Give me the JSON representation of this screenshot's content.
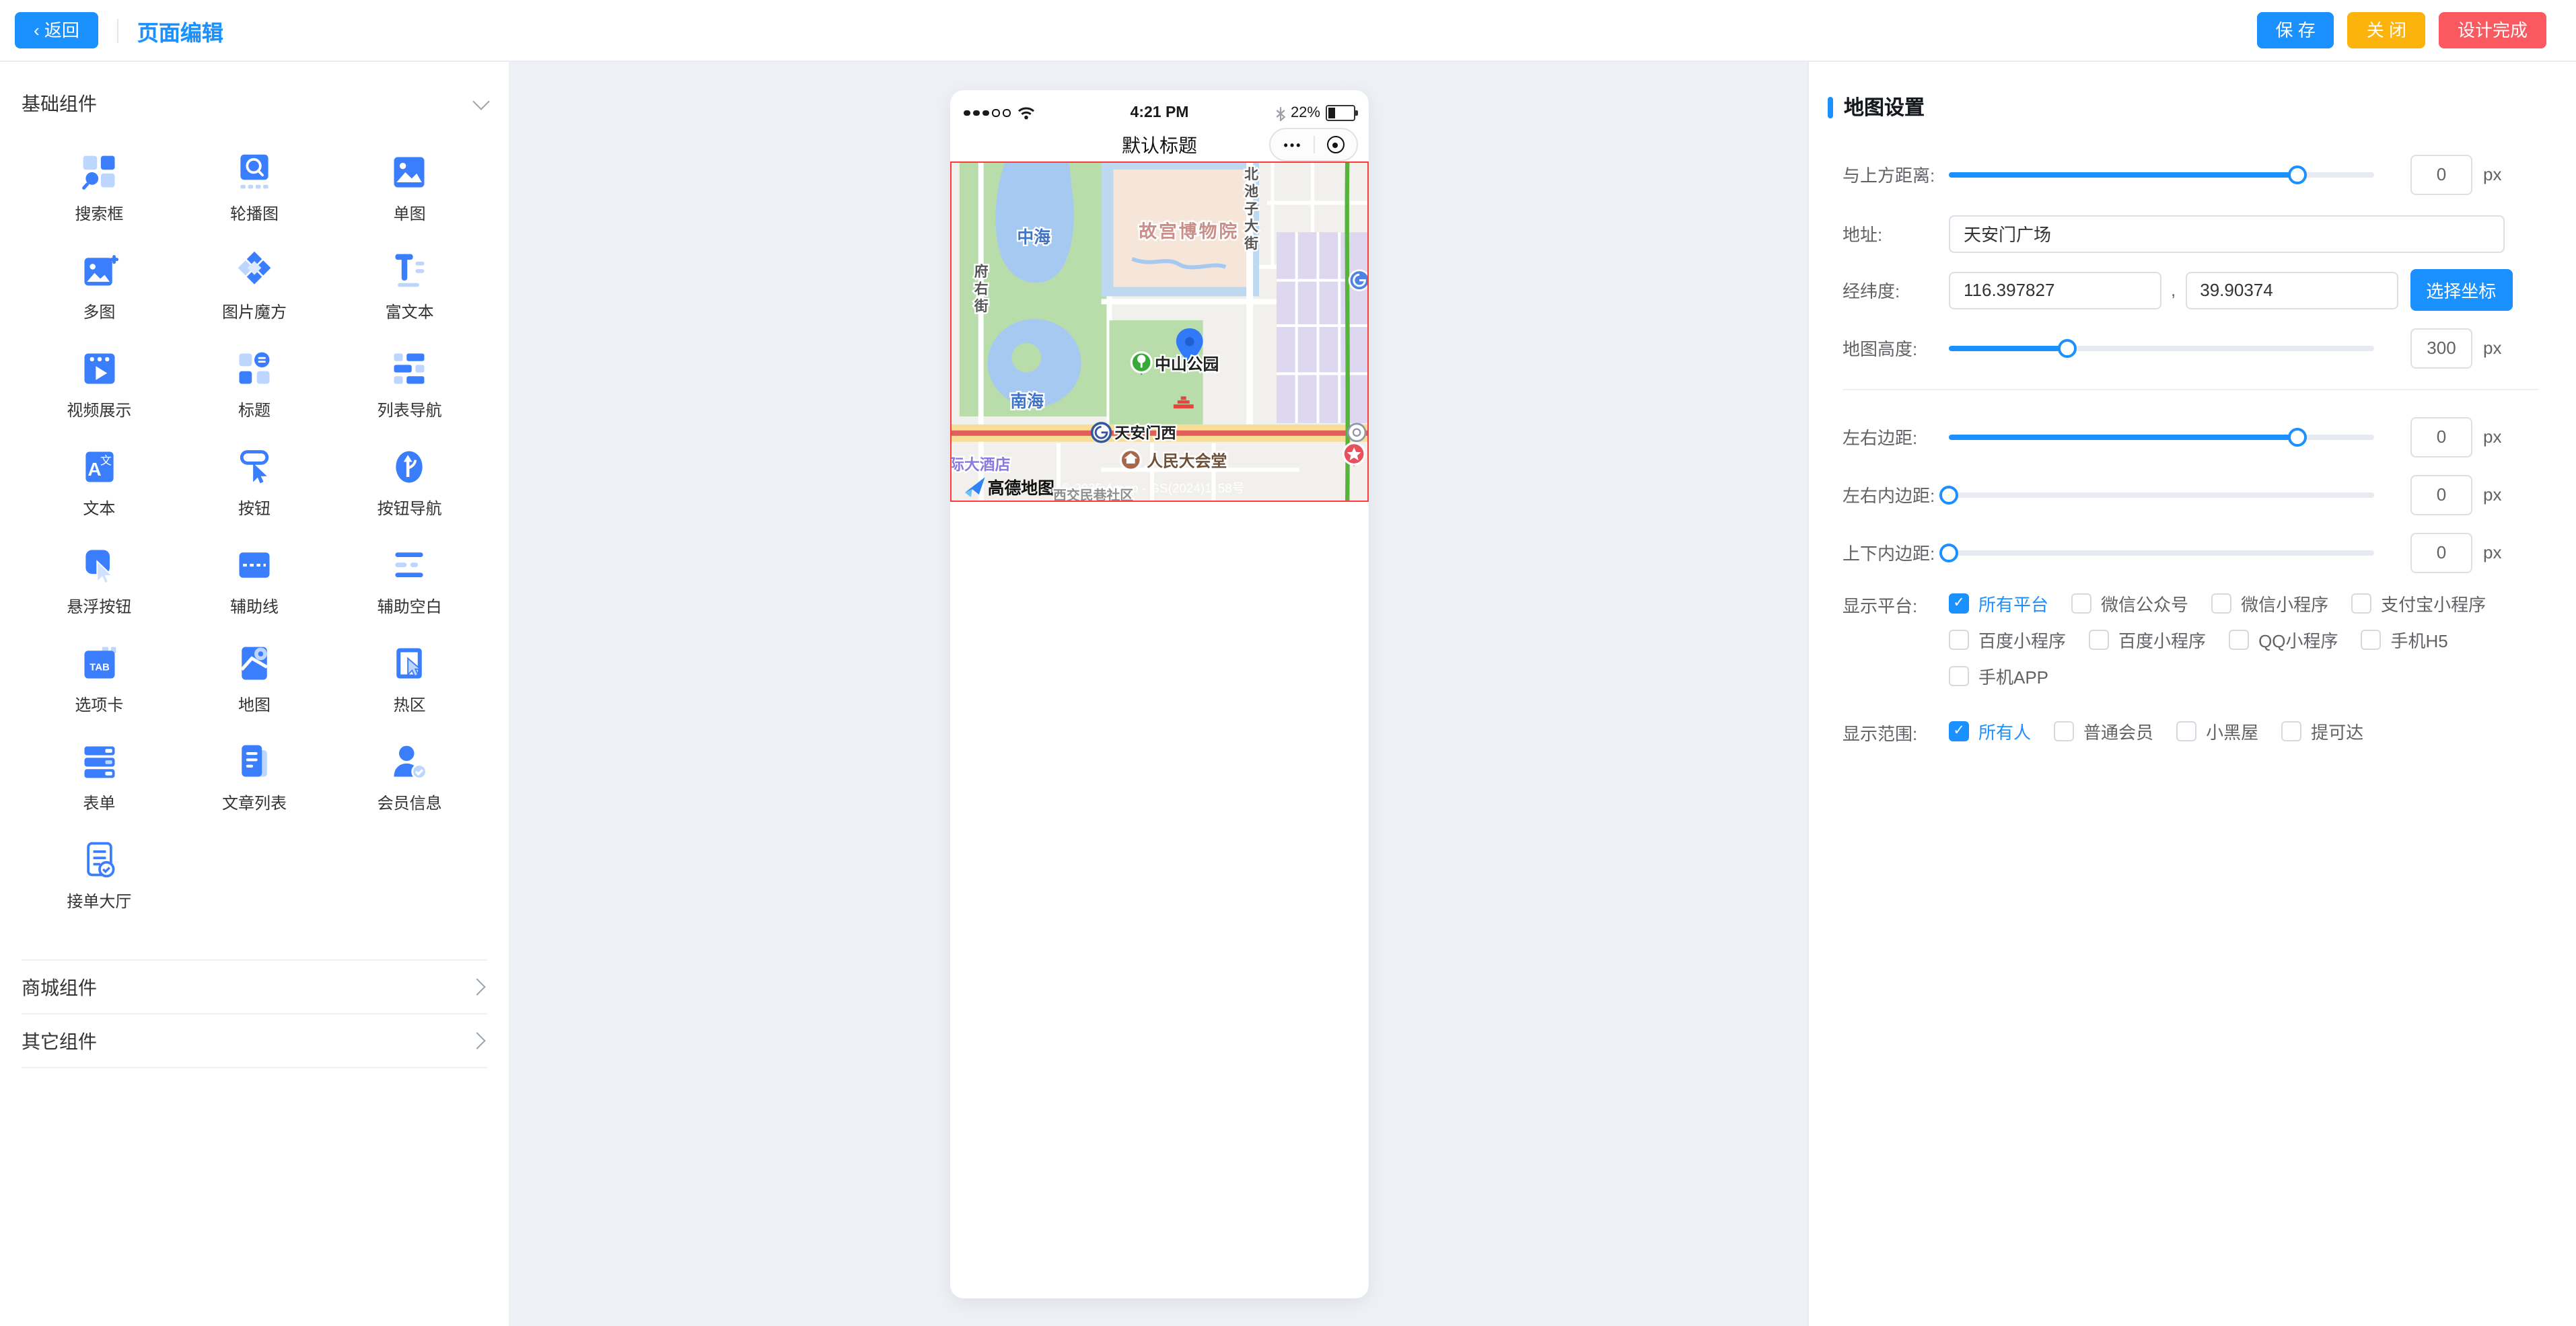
{
  "topbar": {
    "back_label": "‹ 返回",
    "page_title": "页面编辑",
    "save_label": "保 存",
    "close_label": "关 闭",
    "finish_label": "设计完成"
  },
  "sidebar": {
    "basic_section": "基础组件",
    "mall_section": "商城组件",
    "other_section": "其它组件",
    "components": [
      {
        "label": "搜索框",
        "icon": "search-box-icon"
      },
      {
        "label": "轮播图",
        "icon": "carousel-icon"
      },
      {
        "label": "单图",
        "icon": "single-image-icon"
      },
      {
        "label": "多图",
        "icon": "multi-image-icon"
      },
      {
        "label": "图片魔方",
        "icon": "image-cube-icon"
      },
      {
        "label": "富文本",
        "icon": "rich-text-icon"
      },
      {
        "label": "视频展示",
        "icon": "video-icon"
      },
      {
        "label": "标题",
        "icon": "title-icon"
      },
      {
        "label": "列表导航",
        "icon": "list-nav-icon"
      },
      {
        "label": "文本",
        "icon": "text-icon"
      },
      {
        "label": "按钮",
        "icon": "button-icon"
      },
      {
        "label": "按钮导航",
        "icon": "button-nav-icon"
      },
      {
        "label": "悬浮按钮",
        "icon": "float-button-icon"
      },
      {
        "label": "辅助线",
        "icon": "aux-line-icon"
      },
      {
        "label": "辅助空白",
        "icon": "aux-blank-icon"
      },
      {
        "label": "选项卡",
        "icon": "tab-icon"
      },
      {
        "label": "地图",
        "icon": "map-icon"
      },
      {
        "label": "热区",
        "icon": "hot-zone-icon"
      },
      {
        "label": "表单",
        "icon": "form-icon"
      },
      {
        "label": "文章列表",
        "icon": "article-list-icon"
      },
      {
        "label": "会员信息",
        "icon": "member-info-icon"
      },
      {
        "label": "接单大厅",
        "icon": "order-hall-icon"
      }
    ]
  },
  "phone": {
    "time": "4:21 PM",
    "battery_pct": "22%",
    "nav_title": "默认标题",
    "capsule_more": "•••"
  },
  "map": {
    "labels": {
      "gugong": "故宫博物院",
      "zhonghai": "中海",
      "nanhai": "南海",
      "zhongshan_park": "中山公园",
      "tiananmen_west": "天安门西",
      "great_hall": "人民大会堂",
      "hotel": "际大酒店",
      "amap_logo": "高德地图",
      "copyright": "© 2025 Amap - GS(2024)1158号",
      "community": "西交民巷社区",
      "fuyou": [
        "府",
        "右",
        "街"
      ],
      "beichizi": [
        "北",
        "池",
        "子",
        "大",
        "街"
      ]
    }
  },
  "panel": {
    "title": "地图设置",
    "top_margin": {
      "label": "与上方距离:",
      "value": "0",
      "unit": "px",
      "fill_pct": 82
    },
    "address": {
      "label": "地址:",
      "value": "天安门广场"
    },
    "coords": {
      "label": "经纬度:",
      "lng": "116.397827",
      "lat": "39.90374",
      "separator": ",",
      "pick_btn": "选择坐标"
    },
    "map_height": {
      "label": "地图高度:",
      "value": "300",
      "unit": "px",
      "fill_pct": 28
    },
    "lr_margin": {
      "label": "左右边距:",
      "value": "0",
      "unit": "px",
      "fill_pct": 82
    },
    "lr_padding": {
      "label": "左右内边距:",
      "value": "0",
      "unit": "px",
      "fill_pct": 0
    },
    "tb_padding": {
      "label": "上下内边距:",
      "value": "0",
      "unit": "px",
      "fill_pct": 0
    },
    "platforms": {
      "label": "显示平台:",
      "rows": [
        [
          {
            "label": "所有平台",
            "checked": true
          },
          {
            "label": "微信公众号",
            "checked": false
          },
          {
            "label": "微信小程序",
            "checked": false
          },
          {
            "label": "支付宝小程序",
            "checked": false
          }
        ],
        [
          {
            "label": "百度小程序",
            "checked": false
          },
          {
            "label": "百度小程序",
            "checked": false
          },
          {
            "label": "QQ小程序",
            "checked": false
          },
          {
            "label": "手机H5",
            "checked": false
          }
        ],
        [
          {
            "label": "手机APP",
            "checked": false
          }
        ]
      ]
    },
    "range": {
      "label": "显示范围:",
      "rows": [
        [
          {
            "label": "所有人",
            "checked": true
          },
          {
            "label": "普通会员",
            "checked": false
          },
          {
            "label": "小黑屋",
            "checked": false
          },
          {
            "label": "提可达",
            "checked": false
          }
        ]
      ]
    }
  }
}
